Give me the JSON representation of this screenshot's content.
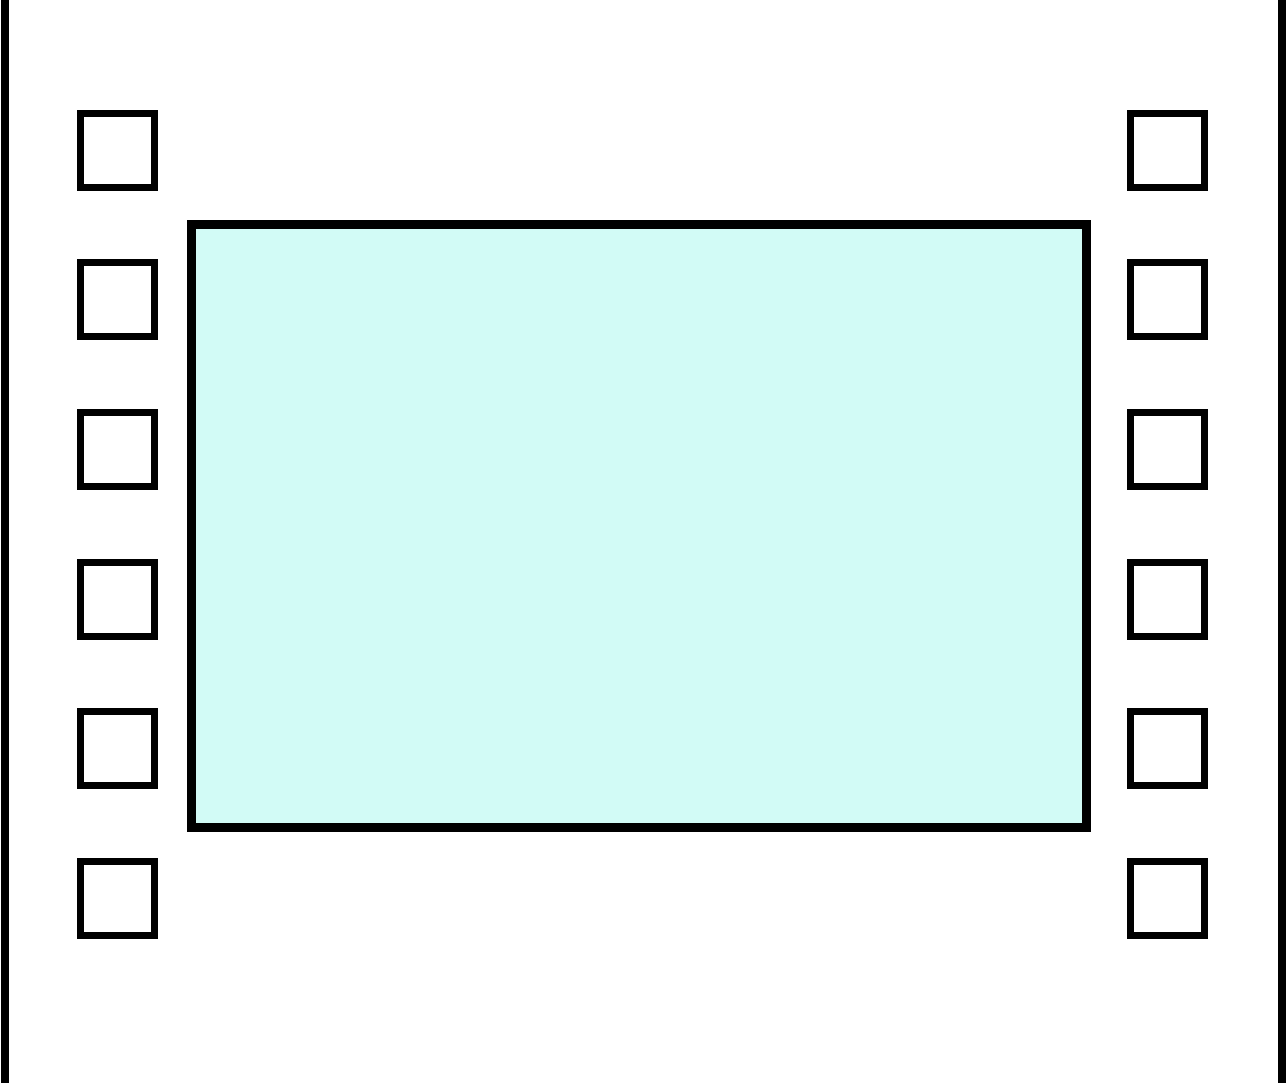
{
  "figure": {
    "kind": "film-strip-frame-graphic",
    "colors": {
      "background": "#ffffff",
      "stroke": "#000000",
      "frame_fill": "#d2fbf6",
      "hole_fill": "#ffffff"
    },
    "edges": {
      "left_x": 1,
      "right_x": 1278,
      "width": 8
    },
    "frame": {
      "x": 187,
      "y": 220,
      "width": 904,
      "height": 612,
      "border": 9
    },
    "sprocket_holes": {
      "count_per_side": 6,
      "size": 81,
      "border": 7,
      "left_column_x": 77,
      "right_column_x": 1127,
      "tops": [
        110,
        259,
        409,
        559,
        708,
        858
      ]
    }
  }
}
